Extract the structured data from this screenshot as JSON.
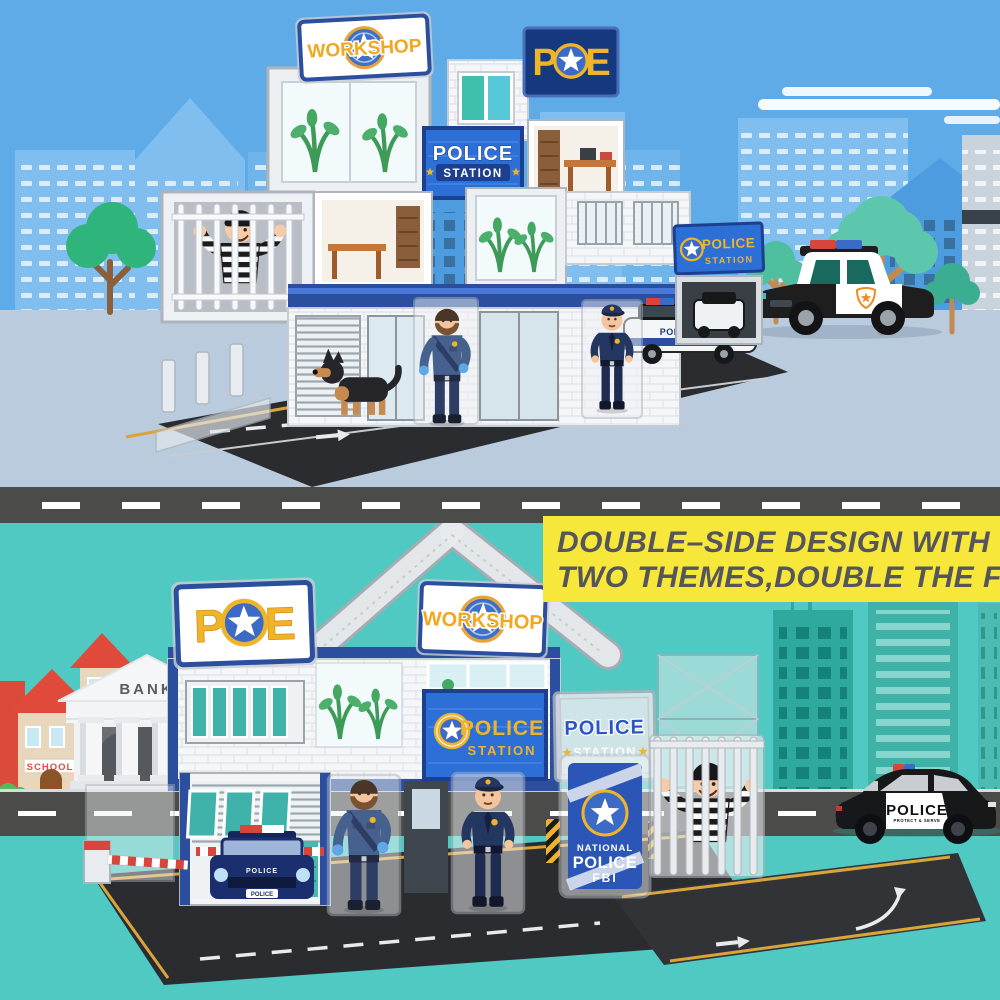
{
  "product_banner": {
    "line1": "DOUBLE–SIDE DESIGN WITH",
    "line2": "TWO THEMES,DOUBLE THE F",
    "bg_color": "#F8E73B",
    "text_color": "#55565C"
  },
  "top_scene": {
    "workshop_sign": "WORKSHOP",
    "pe_sign_left": "P",
    "pe_sign_right": "E",
    "station_sign": {
      "line1": "POLICE",
      "line2": "STATION"
    },
    "station_sign_small": {
      "line1": "POLICE",
      "line2": "STATION"
    },
    "toy_car_label": "POLICE",
    "colors": {
      "sky": "#5FABE8",
      "ground": "#B9CBDC",
      "building_light": "#7FBEEF",
      "building_mid": "#4C9CDF",
      "tree_green": "#2FB57C",
      "tree_teal": "#57C5AA"
    }
  },
  "divider_road": {
    "color": "#4B4B49"
  },
  "bottom_scene": {
    "pe_sign_left": "P",
    "pe_sign_right": "E",
    "workshop_sign": "WORKSHOP",
    "station_sign": {
      "line1": "POLICE",
      "line2": "STATION"
    },
    "station_sign_clear": {
      "line1": "POLICE",
      "line2": "STATION"
    },
    "fbi_banner": {
      "line1": "NATIONAL",
      "line2": "POLICE",
      "line3": "FBI"
    },
    "bank_label": "BANK",
    "school_label": "SCHOOL",
    "police_car": {
      "label": "POLICE",
      "sublabel": "PROTECT & SERVE"
    },
    "garage_car_plate": "POLICE",
    "colors": {
      "sky": "#4FC9C1",
      "building_teal": "#2FA89D",
      "road": "#4B4B49",
      "fbi_blue": "#2B56B8"
    }
  }
}
